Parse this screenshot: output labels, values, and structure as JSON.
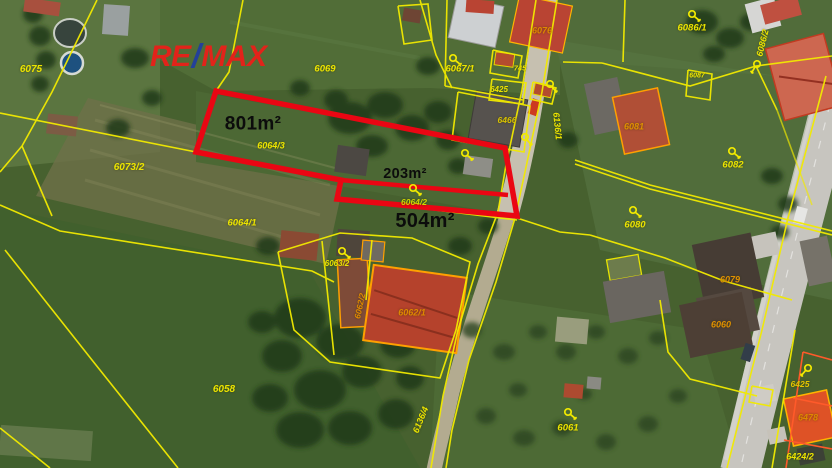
{
  "map": {
    "brand": {
      "re": "RE",
      "slash": "/",
      "max": "MAX",
      "red": "#e2231a",
      "blue": "#23409a"
    },
    "colors": {
      "cadastral_line_yellow": "#f2ea00",
      "cadastral_line_orange": "#ff5a2a",
      "highlight_red": "#ea0613",
      "parcel_label_yellow": "#ece400",
      "parcel_label_orange": "#df8800",
      "area_label_black": "#0c0c0c"
    },
    "area_labels": [
      {
        "text": "801m²",
        "x": 253,
        "y": 124,
        "size": 19,
        "weight": 800
      },
      {
        "text": "203m²",
        "x": 405,
        "y": 174,
        "size": 14.5,
        "weight": 700
      },
      {
        "text": "504m²",
        "x": 425,
        "y": 221,
        "size": 20,
        "weight": 800
      }
    ],
    "parcel_labels": [
      {
        "text": "6075",
        "x": 31,
        "y": 70,
        "size": 10
      },
      {
        "text": "6073/2",
        "x": 129,
        "y": 168,
        "size": 10
      },
      {
        "text": "6069",
        "x": 325,
        "y": 69,
        "size": 9.5
      },
      {
        "text": "6064/3",
        "x": 271,
        "y": 146,
        "size": 9
      },
      {
        "text": "6064/1",
        "x": 242,
        "y": 223,
        "size": 9.5
      },
      {
        "text": "6064/2",
        "x": 414,
        "y": 202,
        "size": 8.5,
        "color": "#cfd600"
      },
      {
        "text": "6067/1",
        "x": 460,
        "y": 69,
        "size": 9.5
      },
      {
        "text": "745",
        "x": 520,
        "y": 68,
        "size": 7.5
      },
      {
        "text": "6425",
        "x": 499,
        "y": 90,
        "size": 8
      },
      {
        "text": "6466",
        "x": 507,
        "y": 120,
        "size": 8.5,
        "color": "#d8c100"
      },
      {
        "text": "6136/1",
        "x": 557,
        "y": 126,
        "size": 9,
        "rot": 84
      },
      {
        "text": "6076",
        "x": 542,
        "y": 31,
        "size": 9,
        "color": "#df8800"
      },
      {
        "text": "6086/1",
        "x": 692,
        "y": 28,
        "size": 9.5
      },
      {
        "text": "6087",
        "x": 697,
        "y": 76,
        "size": 7
      },
      {
        "text": "6086/2",
        "x": 763,
        "y": 43,
        "size": 9,
        "rot": -76
      },
      {
        "text": "6082",
        "x": 733,
        "y": 165,
        "size": 9.5
      },
      {
        "text": "6081",
        "x": 634,
        "y": 127,
        "size": 9,
        "color": "#df9000"
      },
      {
        "text": "6080",
        "x": 635,
        "y": 225,
        "size": 9.5
      },
      {
        "text": "6079",
        "x": 730,
        "y": 280,
        "size": 9,
        "color": "#df9000"
      },
      {
        "text": "6060",
        "x": 721,
        "y": 325,
        "size": 9,
        "color": "#df9000"
      },
      {
        "text": "6061",
        "x": 568,
        "y": 428,
        "size": 9.5
      },
      {
        "text": "6058",
        "x": 224,
        "y": 390,
        "size": 10
      },
      {
        "text": "6062/1",
        "x": 412,
        "y": 313,
        "size": 9,
        "color": "#df8800"
      },
      {
        "text": "6062/2",
        "x": 360,
        "y": 306,
        "size": 8.5,
        "rot": -78,
        "color": "#df8800"
      },
      {
        "text": "6063/2",
        "x": 337,
        "y": 264,
        "size": 8
      },
      {
        "text": "6136/4",
        "x": 421,
        "y": 420,
        "size": 9,
        "rot": -68
      },
      {
        "text": "6425",
        "x": 800,
        "y": 384,
        "size": 8.5,
        "color": "#e4c400"
      },
      {
        "text": "6478",
        "x": 808,
        "y": 418,
        "size": 9,
        "color": "#df8800"
      },
      {
        "text": "6424/2",
        "x": 800,
        "y": 457,
        "size": 9
      }
    ],
    "key_icons": [
      {
        "x": 453,
        "y": 58,
        "rot": 0
      },
      {
        "x": 550,
        "y": 84,
        "rot": 10
      },
      {
        "x": 465,
        "y": 153,
        "rot": 0
      },
      {
        "x": 413,
        "y": 188,
        "rot": 0
      },
      {
        "x": 525,
        "y": 137,
        "rot": 10
      },
      {
        "x": 692,
        "y": 14,
        "rot": 0
      },
      {
        "x": 757,
        "y": 64,
        "rot": 80
      },
      {
        "x": 732,
        "y": 151,
        "rot": 0
      },
      {
        "x": 633,
        "y": 210,
        "rot": 0
      },
      {
        "x": 568,
        "y": 412,
        "rot": 0
      },
      {
        "x": 342,
        "y": 251,
        "rot": 0
      },
      {
        "x": 808,
        "y": 368,
        "rot": 90
      }
    ]
  }
}
